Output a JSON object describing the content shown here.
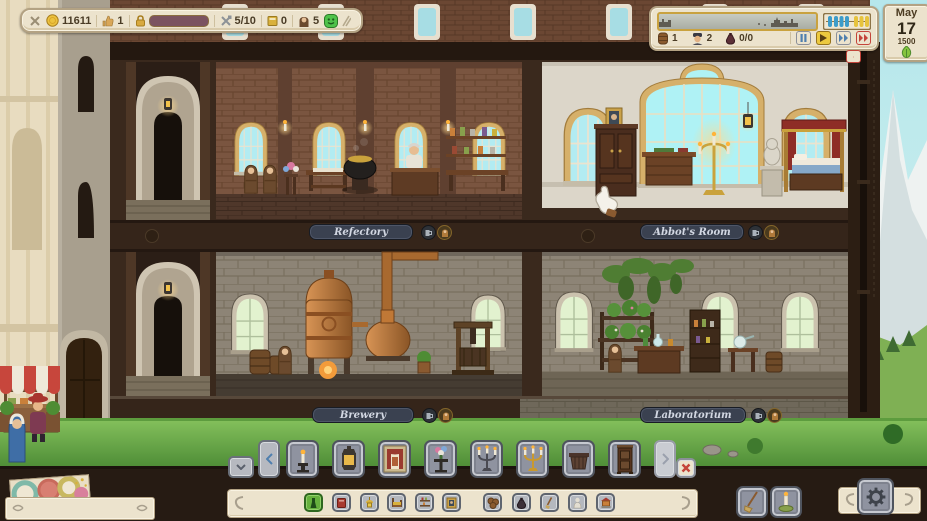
{
  "top_bar": {
    "gold": "11611",
    "reputation": "1",
    "build_progress_pct": 68,
    "workers": "5/10",
    "ledger": "0",
    "monks": "5"
  },
  "time_panel": {
    "barrels": "1",
    "guests": "2",
    "deliveries": "0/0",
    "abacus": {
      "blue_beads": 4,
      "yellow_beads": 3
    },
    "speed_controls": [
      "pause",
      "play",
      "fast-forward",
      "max-speed"
    ],
    "active_speed": "play"
  },
  "date_card": {
    "month": "May",
    "day": "17",
    "year": "1500",
    "season": "spring"
  },
  "rooms": {
    "refectory": "Refectory",
    "abbots_room": "Abbot's Room",
    "brewery": "Brewery",
    "laboratorium": "Laboratorium"
  },
  "hotbar": {
    "items": [
      "candle-holder",
      "lantern",
      "wall-tapestry",
      "flower-stand",
      "iron-candelabra",
      "gold-candelabra",
      "wooden-planter",
      "tall-cabinet"
    ]
  },
  "categories": {
    "selected": "plants",
    "items": [
      "plants",
      "books",
      "lamps",
      "beds",
      "shelves",
      "portraits",
      "kegs",
      "sacks",
      "tools",
      "statues",
      "shrines"
    ]
  },
  "colors": {
    "parchment": "#ece3cd",
    "parchment_border": "#b3a283",
    "label_bg": "#3a4150",
    "label_text": "#d2d7e2",
    "accent_green": "#5dbd3e",
    "accent_yellow": "#ecc93f",
    "accent_red": "#c4443a",
    "progress_green": "#5fc13d"
  }
}
